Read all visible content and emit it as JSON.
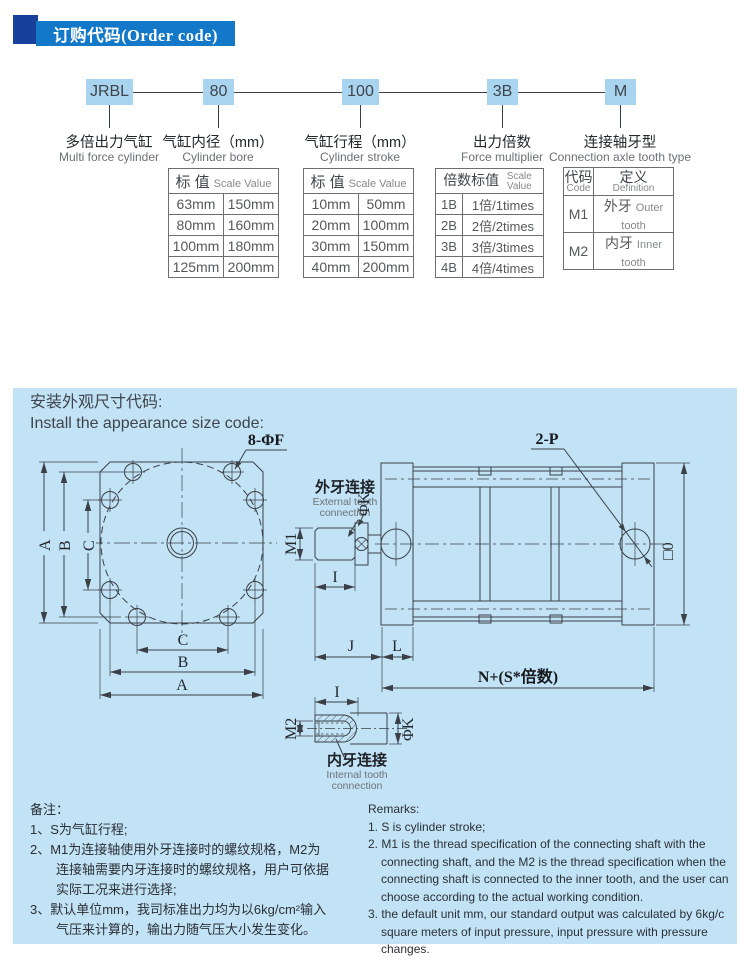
{
  "header": {
    "title": "订购代码(Order code)",
    "banner_color": "#1478C9",
    "accent_color": "#17409A"
  },
  "order_code": {
    "box_color": "#A8D4F0",
    "segments": [
      {
        "code": "JRBL",
        "label_cn": "多倍出力气缸",
        "label_en": "Multi force cylinder"
      },
      {
        "code": "80",
        "label_cn": "气缸内径（mm）",
        "label_en": "Cylinder bore"
      },
      {
        "code": "100",
        "label_cn": "气缸行程（mm）",
        "label_en": "Cylinder stroke"
      },
      {
        "code": "3B",
        "label_cn": "出力倍数",
        "label_en": "Force multiplier"
      },
      {
        "code": "M",
        "label_cn": "连接轴牙型",
        "label_en": "Connection axle tooth type"
      }
    ]
  },
  "tables": {
    "bore": {
      "header_cn": "标 值",
      "header_en": "Scale Value",
      "rows": [
        [
          "63mm",
          "150mm"
        ],
        [
          "80mm",
          "160mm"
        ],
        [
          "100mm",
          "180mm"
        ],
        [
          "125mm",
          "200mm"
        ]
      ]
    },
    "stroke": {
      "header_cn": "标 值",
      "header_en": "Scale Value",
      "rows": [
        [
          "10mm",
          "50mm"
        ],
        [
          "20mm",
          "100mm"
        ],
        [
          "30mm",
          "150mm"
        ],
        [
          "40mm",
          "200mm"
        ]
      ]
    },
    "multiplier": {
      "header_cn": "倍数标值",
      "header_en": "Scale Value",
      "rows": [
        [
          "1B",
          "1倍/1times"
        ],
        [
          "2B",
          "2倍/2times"
        ],
        [
          "3B",
          "3倍/3times"
        ],
        [
          "4B",
          "4倍/4times"
        ]
      ]
    },
    "tooth": {
      "header_col1_cn": "代码",
      "header_col1_en": "Code",
      "header_col2_cn": "定义",
      "header_col2_en": "Definition",
      "rows": [
        {
          "code": "M1",
          "cn": "外牙",
          "en": "Outer tooth"
        },
        {
          "code": "M2",
          "cn": "内牙",
          "en": "Inner tooth"
        }
      ]
    }
  },
  "install": {
    "title_cn": "安装外观尺寸代码:",
    "title_en": "Install the appearance size code:",
    "panel_color": "#C2E2F6",
    "labels": {
      "bolt_holes": "8-ΦF",
      "ports": "2-P",
      "a": "A",
      "b": "B",
      "c": "C",
      "i": "I",
      "j": "J",
      "l": "L",
      "m1": "M1",
      "m2": "M2",
      "phi_k": "ΦK",
      "square_o": "□0",
      "total_length": "N+(S*倍数)",
      "ext_cn": "外牙连接",
      "ext_en_1": "External tooth",
      "ext_en_2": "connection",
      "int_cn": "内牙连接",
      "int_en_1": "Internal tooth",
      "int_en_2": "connection"
    }
  },
  "remarks_cn": {
    "lines": [
      "备注：",
      "1、S为气缸行程;",
      "2、M1为连接轴使用外牙连接时的螺纹规格，M2为",
      "连接轴需要内牙连接时的螺纹规格，用户可依据",
      "实际工况来进行选择;",
      "3、默认单位mm，我司标准出力均为以6kg/cm²输入",
      "气压来计算的，输出力随气压大小发生变化。"
    ]
  },
  "remarks_en": {
    "lines": [
      "Remarks:",
      "1. S is cylinder stroke;",
      "2. M1 is the thread specification of the connecting shaft with the",
      "connecting shaft, and the M2 is the thread specification when the",
      "connecting shaft is connected to the inner tooth, and the user can",
      "choose according to the actual working condition.",
      "3. the default unit mm, our standard output was calculated by 6kg/c",
      "square meters of input pressure, input pressure with pressure changes."
    ]
  }
}
